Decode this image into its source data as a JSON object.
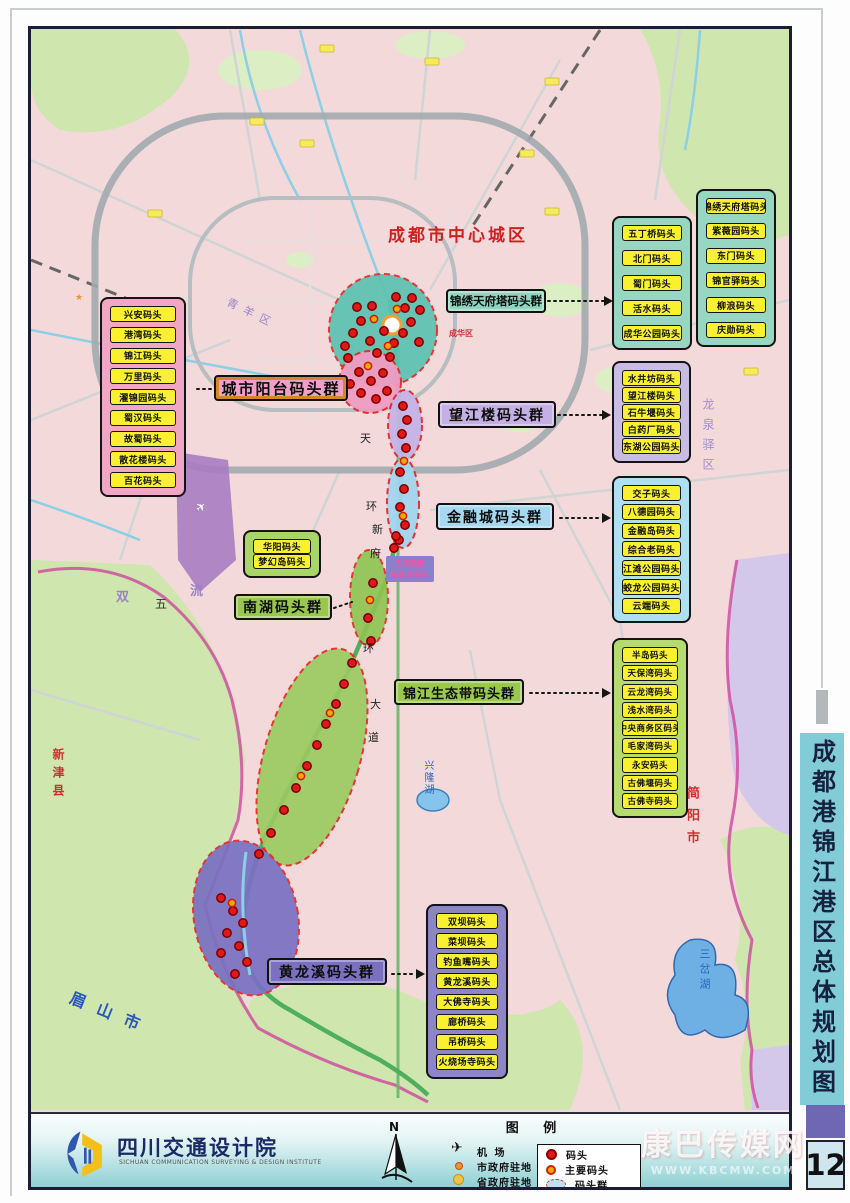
{
  "sidebar": {
    "title": "成都港锦江港区总体规划图",
    "page": "12"
  },
  "footer": {
    "publisher": "四川交通设计院",
    "publisher_sub": "SICHUAN COMMUNICATION SURVEYING & DESIGN INSTITUTE"
  },
  "watermark": {
    "name": "康巴传媒网",
    "site": "WWW.KBCMW.COM"
  },
  "legend": {
    "title": "图 例",
    "north": "N",
    "site_items": [
      {
        "icon": "airport-icon",
        "label": "机  场"
      },
      {
        "icon": "city-gov-dot",
        "label": "市政府驻地"
      },
      {
        "icon": "prov-gov-dot",
        "label": "省政府驻地"
      }
    ],
    "dock_items": [
      {
        "icon": "dock-dot",
        "label": "码头"
      },
      {
        "icon": "main-dock-dot",
        "label": "主要码头"
      },
      {
        "icon": "dock-group-ellipse",
        "label": "码头群"
      }
    ]
  },
  "map": {
    "center_city_label": "成都市中心城区",
    "labels": {
      "chenghua": "成华区",
      "qingyang": "青羊区",
      "longquanyi": "龙泉驿区",
      "shuang": "双",
      "liu": "流",
      "wu": "五",
      "xinjin": "新津县",
      "meishan": "眉山市",
      "jianyang": "简阳市",
      "sancha_lake": "三岔湖",
      "xinglong_lake": "兴隆湖",
      "airport": "国际机场",
      "tianfu_line1": "天府新区",
      "tianfu_line2": "成都直管区"
    },
    "road_chars": [
      "天",
      "环",
      "新",
      "府",
      "环",
      "大",
      "道"
    ],
    "groups": [
      {
        "id": "city-balcony",
        "label": "城市阳台码头群",
        "items": [
          "兴安码头",
          "港湾码头",
          "锦江码头",
          "万里码头",
          "濯锦园码头",
          "蜀汉码头",
          "故蜀码头",
          "散花楼码头",
          "百花码头"
        ]
      },
      {
        "id": "jinxiu-tianfu-tower",
        "label": "锦绣天府塔码头群",
        "items_a": [
          "五丁桥码头",
          "北门码头",
          "蜀门码头",
          "活水码头",
          "成华公园码头"
        ],
        "items_b": [
          "锦绣天府塔码头",
          "紫薇园码头",
          "东门码头",
          "锦官驿码头",
          "柳浪码头",
          "庆勋码头"
        ]
      },
      {
        "id": "wangjianglou",
        "label": "望江楼码头群",
        "items": [
          "水井坊码头",
          "望江楼码头",
          "石牛堰码头",
          "白药厂码头",
          "东湖公园码头"
        ]
      },
      {
        "id": "financial-city",
        "label": "金融城码头群",
        "items": [
          "交子码头",
          "八德园码头",
          "金融岛码头",
          "综合老码头",
          "江滩公园码头",
          "蛟龙公园码头",
          "云端码头"
        ]
      },
      {
        "id": "nanhu",
        "label": "南湖码头群",
        "items": [
          "华阳码头",
          "梦幻岛码头"
        ]
      },
      {
        "id": "eco-belt",
        "label": "锦江生态带码头群",
        "items": [
          "半岛码头",
          "天保湾码头",
          "云龙湾码头",
          "浅水湾码头",
          "中央商务区码头",
          "毛家湾码头",
          "永安码头",
          "古佛堰码头",
          "古佛寺码头"
        ]
      },
      {
        "id": "huanglongxi",
        "label": "黄龙溪码头群",
        "items": [
          "双坝码头",
          "菜坝码头",
          "钓鱼嘴码头",
          "黄龙溪码头",
          "大佛寺码头",
          "廊桥码头",
          "吊桥码头",
          "火烧场寺码头"
        ]
      }
    ],
    "dock_markers": {
      "dock": [
        [
          345,
          346
        ],
        [
          353,
          333
        ],
        [
          361,
          321
        ],
        [
          370,
          341
        ],
        [
          377,
          353
        ],
        [
          348,
          358
        ],
        [
          384,
          331
        ],
        [
          394,
          343
        ],
        [
          403,
          333
        ],
        [
          411,
          322
        ],
        [
          405,
          308
        ],
        [
          396,
          297
        ],
        [
          412,
          298
        ],
        [
          419,
          342
        ],
        [
          390,
          357
        ],
        [
          372,
          306
        ],
        [
          357,
          307
        ],
        [
          420,
          310
        ],
        [
          359,
          372
        ],
        [
          371,
          381
        ],
        [
          383,
          373
        ],
        [
          361,
          393
        ],
        [
          376,
          399
        ],
        [
          387,
          391
        ],
        [
          350,
          384
        ],
        [
          403,
          406
        ],
        [
          407,
          420
        ],
        [
          402,
          434
        ],
        [
          406,
          448
        ],
        [
          400,
          472
        ],
        [
          404,
          489
        ],
        [
          400,
          507
        ],
        [
          405,
          525
        ],
        [
          399,
          540
        ],
        [
          396,
          536
        ],
        [
          394,
          548
        ],
        [
          373,
          583
        ],
        [
          368,
          618
        ],
        [
          371,
          641
        ],
        [
          352,
          663
        ],
        [
          344,
          684
        ],
        [
          336,
          704
        ],
        [
          326,
          724
        ],
        [
          317,
          745
        ],
        [
          307,
          766
        ],
        [
          296,
          788
        ],
        [
          284,
          810
        ],
        [
          271,
          833
        ],
        [
          259,
          854
        ],
        [
          221,
          898
        ],
        [
          233,
          911
        ],
        [
          243,
          923
        ],
        [
          227,
          933
        ],
        [
          239,
          946
        ],
        [
          221,
          953
        ],
        [
          247,
          962
        ],
        [
          235,
          974
        ]
      ],
      "main_dock": [
        [
          374,
          319
        ],
        [
          397,
          309
        ],
        [
          388,
          346
        ],
        [
          368,
          366
        ],
        [
          404,
          461
        ],
        [
          403,
          516
        ],
        [
          370,
          600
        ],
        [
          330,
          713
        ],
        [
          301,
          776
        ],
        [
          232,
          903
        ]
      ]
    }
  }
}
